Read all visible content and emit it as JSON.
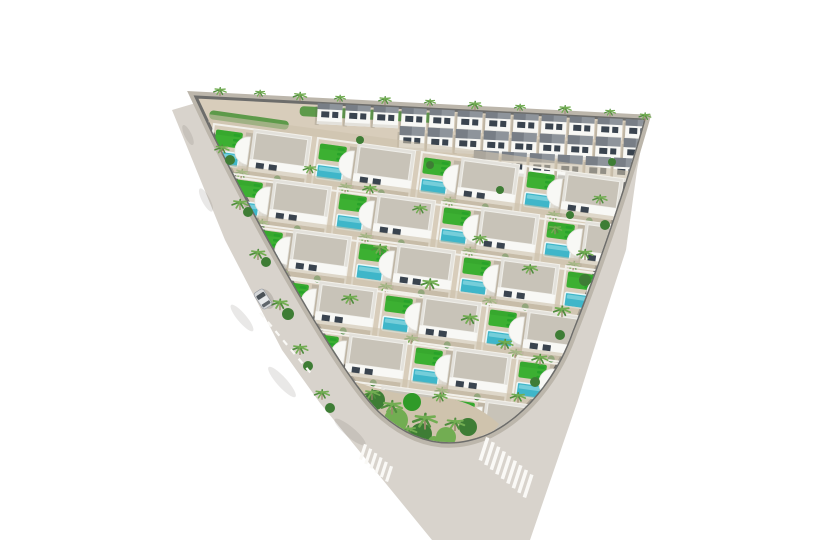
{
  "colors": {
    "background": "#ffffff",
    "road": "#d8d3cc",
    "road_edge_dark": "#6d6d6b",
    "sidewalk": "#bcb6ab",
    "ground": "#d8cdbb",
    "row_path": "#cdc1ac",
    "parcel_line": "#f2f0ea",
    "house": "#f8f8f5",
    "house_shade": "#e3e1db",
    "roof": "#c8c3b8",
    "roof_edge": "#efeee9",
    "townhouse_roof": "#8e949b",
    "townhouse_roof_dark": "#6f757d",
    "window": "#3a444f",
    "pool": "#3fb6c9",
    "pool_light": "#9adde6",
    "pool_edge": "#eaf7f8",
    "lawn": "#3cb032",
    "lawn_dark": "#2f9a28",
    "lounger": "#27a32a",
    "palm": "#4f8d3d",
    "palm_light": "#72ad52",
    "bush": "#3e7d35",
    "trunk": "#9b8a6c",
    "shadow": "rgba(90,85,75,0.20)",
    "road_shadow": "rgba(95,90,80,0.30)",
    "car_body": "#d6d8da",
    "car_roof": "#e8eaec",
    "car_window": "#4b5258",
    "stripe": "#faf9f6",
    "hedge": "#5d9a4a",
    "garden_ground": "#cfc3ad"
  },
  "scene": {
    "width": 825,
    "height": 540,
    "road_hull": "M172,110 L206,100 L646,121 L637,170 L626,250 L600,330 L577,403 L530,540 L432,540 L320,403 L282,350 L225,240 Z",
    "plot": "M196,97 L644,120 C630,170 600,262 572,332 C556,378 524,416 489,433 Q431,459 379,411 C341,374 258,225 212,131 Z",
    "apex_garden": {
      "ground": "M356,382 Q340,408 378,428 Q414,452 456,448 Q488,442 499,424 Q470,398 438,398 Q396,396 356,382 Z",
      "blobs": [
        {
          "x": 375,
          "y": 400,
          "r": 10,
          "c": "bush"
        },
        {
          "x": 396,
          "y": 420,
          "r": 12,
          "c": "palm_light"
        },
        {
          "x": 421,
          "y": 434,
          "r": 11,
          "c": "bush"
        },
        {
          "x": 446,
          "y": 437,
          "r": 10,
          "c": "palm_light"
        },
        {
          "x": 468,
          "y": 427,
          "r": 9,
          "c": "bush"
        },
        {
          "x": 412,
          "y": 402,
          "r": 9,
          "c": "lawn_dark"
        },
        {
          "x": 434,
          "y": 442,
          "r": 6,
          "c": "palm_light"
        }
      ],
      "palms": [
        {
          "x": 392,
          "y": 408,
          "s": 1.3
        },
        {
          "x": 425,
          "y": 422,
          "s": 1.5
        },
        {
          "x": 455,
          "y": 425,
          "s": 1.2
        },
        {
          "x": 408,
          "y": 432,
          "s": 1.1
        },
        {
          "x": 372,
          "y": 395,
          "s": 1.0
        },
        {
          "x": 440,
          "y": 398,
          "s": 0.9
        }
      ]
    },
    "villa_rows": [
      {
        "x": 214,
        "y": 124,
        "count": 4,
        "dx": 104,
        "dy": 14,
        "rot": 7.7
      },
      {
        "x": 234,
        "y": 174,
        "count": 4,
        "dx": 104,
        "dy": 14,
        "rot": 7.7
      },
      {
        "x": 254,
        "y": 224,
        "count": 4,
        "dx": 104,
        "dy": 14,
        "rot": 7.7
      },
      {
        "x": 280,
        "y": 276,
        "count": 4,
        "dx": 104,
        "dy": 14,
        "rot": 7.7
      },
      {
        "x": 310,
        "y": 328,
        "count": 3,
        "dx": 104,
        "dy": 14,
        "rot": 7.7
      },
      {
        "x": 342,
        "y": 380,
        "count": 2,
        "dx": 104,
        "dy": 14,
        "rot": 7.7
      }
    ],
    "townhouse_rows": [
      {
        "x": 318,
        "y": 100,
        "count": 12,
        "dx": 28,
        "dy": 1.5,
        "rot": 3
      },
      {
        "x": 400,
        "y": 126,
        "count": 9,
        "dx": 28,
        "dy": 1.5,
        "rot": 3
      },
      {
        "x": 474,
        "y": 150,
        "count": 7,
        "dx": 28,
        "dy": 1.5,
        "rot": 3
      }
    ],
    "hedges": [
      {
        "x": 300,
        "y": 106,
        "w": 150,
        "h": 10,
        "rot": 3
      },
      {
        "x": 210,
        "y": 110,
        "w": 80,
        "h": 9,
        "rot": 8
      }
    ],
    "palms_top": [
      {
        "x": 220,
        "y": 92,
        "s": 0.8
      },
      {
        "x": 260,
        "y": 94,
        "s": 0.7
      },
      {
        "x": 300,
        "y": 97,
        "s": 0.85
      },
      {
        "x": 340,
        "y": 99,
        "s": 0.7
      },
      {
        "x": 385,
        "y": 101,
        "s": 0.8
      },
      {
        "x": 430,
        "y": 103,
        "s": 0.7
      },
      {
        "x": 475,
        "y": 106,
        "s": 0.85
      },
      {
        "x": 520,
        "y": 108,
        "s": 0.7
      },
      {
        "x": 565,
        "y": 110,
        "s": 0.8
      },
      {
        "x": 610,
        "y": 113,
        "s": 0.7
      },
      {
        "x": 645,
        "y": 117,
        "s": 0.75
      }
    ],
    "palms_edge_left": [
      {
        "x": 222,
        "y": 150,
        "s": 0.9
      },
      {
        "x": 240,
        "y": 205,
        "s": 1.0
      },
      {
        "x": 258,
        "y": 255,
        "s": 1.0
      },
      {
        "x": 280,
        "y": 305,
        "s": 1.05
      },
      {
        "x": 300,
        "y": 350,
        "s": 1.0
      },
      {
        "x": 322,
        "y": 395,
        "s": 0.95
      }
    ],
    "palms_edge_right": [
      {
        "x": 600,
        "y": 200,
        "s": 0.9
      },
      {
        "x": 585,
        "y": 255,
        "s": 1.0
      },
      {
        "x": 562,
        "y": 312,
        "s": 1.05
      },
      {
        "x": 540,
        "y": 360,
        "s": 1.0
      },
      {
        "x": 518,
        "y": 398,
        "s": 0.95
      }
    ],
    "palms_center": [
      {
        "x": 380,
        "y": 250,
        "s": 1.0
      },
      {
        "x": 430,
        "y": 285,
        "s": 1.1
      },
      {
        "x": 470,
        "y": 320,
        "s": 1.05
      },
      {
        "x": 350,
        "y": 300,
        "s": 1.0
      },
      {
        "x": 505,
        "y": 345,
        "s": 1.0
      },
      {
        "x": 420,
        "y": 210,
        "s": 0.9
      },
      {
        "x": 480,
        "y": 240,
        "s": 0.9
      },
      {
        "x": 530,
        "y": 270,
        "s": 0.95
      },
      {
        "x": 555,
        "y": 230,
        "s": 0.85
      },
      {
        "x": 370,
        "y": 190,
        "s": 0.9
      },
      {
        "x": 310,
        "y": 170,
        "s": 0.85
      }
    ],
    "bushes": [
      {
        "x": 230,
        "y": 160,
        "r": 5
      },
      {
        "x": 248,
        "y": 212,
        "r": 5
      },
      {
        "x": 266,
        "y": 262,
        "r": 5
      },
      {
        "x": 288,
        "y": 314,
        "r": 6
      },
      {
        "x": 308,
        "y": 366,
        "r": 5
      },
      {
        "x": 330,
        "y": 408,
        "r": 5
      },
      {
        "x": 605,
        "y": 225,
        "r": 5
      },
      {
        "x": 585,
        "y": 280,
        "r": 6
      },
      {
        "x": 560,
        "y": 335,
        "r": 5
      },
      {
        "x": 535,
        "y": 382,
        "r": 5
      },
      {
        "x": 360,
        "y": 140,
        "r": 4
      },
      {
        "x": 430,
        "y": 165,
        "r": 4
      },
      {
        "x": 500,
        "y": 190,
        "r": 4
      },
      {
        "x": 570,
        "y": 215,
        "r": 4
      },
      {
        "x": 612,
        "y": 162,
        "r": 4
      }
    ],
    "crosswalks": [
      {
        "x": 363,
        "y": 452,
        "dir": 40,
        "count": 6,
        "step": 6.8,
        "len": 16,
        "w": 3.2,
        "stripe_rot": 18
      },
      {
        "x": 484,
        "y": 449,
        "dir": 40,
        "count": 9,
        "step": 7.2,
        "len": 24,
        "w": 3.6,
        "stripe_rot": 18
      }
    ],
    "edge_dashes": {
      "x": 262,
      "y": 315,
      "dir": 50,
      "count": 7,
      "step": 12,
      "len": 6,
      "w": 2.2
    },
    "road_shadows": [
      {
        "x": 242,
        "y": 318,
        "w": 34,
        "h": 9,
        "rot": 50
      },
      {
        "x": 282,
        "y": 382,
        "w": 40,
        "h": 10,
        "rot": 48
      },
      {
        "x": 206,
        "y": 200,
        "w": 26,
        "h": 8,
        "rot": 62
      },
      {
        "x": 188,
        "y": 135,
        "w": 22,
        "h": 7,
        "rot": 64
      },
      {
        "x": 350,
        "y": 432,
        "w": 40,
        "h": 10,
        "rot": 40
      }
    ],
    "car": {
      "x": 263,
      "y": 299,
      "rot": -33
    }
  }
}
